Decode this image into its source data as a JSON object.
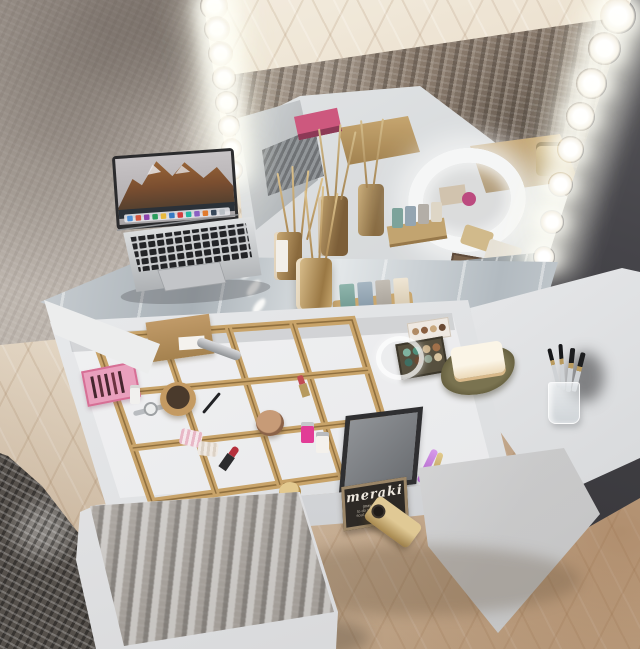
{
  "scene": {
    "description": "3D interior render: white vanity dressing table with Hollywood lighted mirror, open makeup drawer with wooden organizer, MacBook laptop, reed diffusers, LED ring mirror reflection, brush cup, fur stool and shaggy rug on herringbone floor",
    "objects": [
      "lighted mirror",
      "led bulbs",
      "macbook laptop",
      "glass desk top",
      "open makeup drawer",
      "wooden organizer grid",
      "reed diffuser bottles",
      "scented candles",
      "led ring mirror",
      "makeup brushes cup",
      "eyeshadow palettes",
      "soap bar",
      "chalkboard sign",
      "gold perfume bottle",
      "fur stool",
      "dark shaggy rug",
      "herringbone wood floor",
      "concrete wall"
    ],
    "sign": {
      "title": "meraki",
      "pronunciation": "(may-rah-kee)",
      "line1": "to do something with",
      "line2": "soul, creativity or love"
    },
    "colors": {
      "wall_left": "#b4aba2",
      "wall_right": "#454449",
      "floor_light": "#e9dfd0",
      "floor_warm": "#b08a62",
      "rug_reflection": "#8b7a6b",
      "rug_dark": "#55504b",
      "desk_white": "#f2f3f4",
      "organizer_wood": "#c8a369",
      "glass_top": "#bfc6cb",
      "amber_glass": "#b98f57",
      "bulb_glow": "#ffffff",
      "palette_pink": "#e9a0bd",
      "candle_teal": "#7ea69e",
      "gold": "#c2a368",
      "sign_board": "#2d2925"
    }
  }
}
